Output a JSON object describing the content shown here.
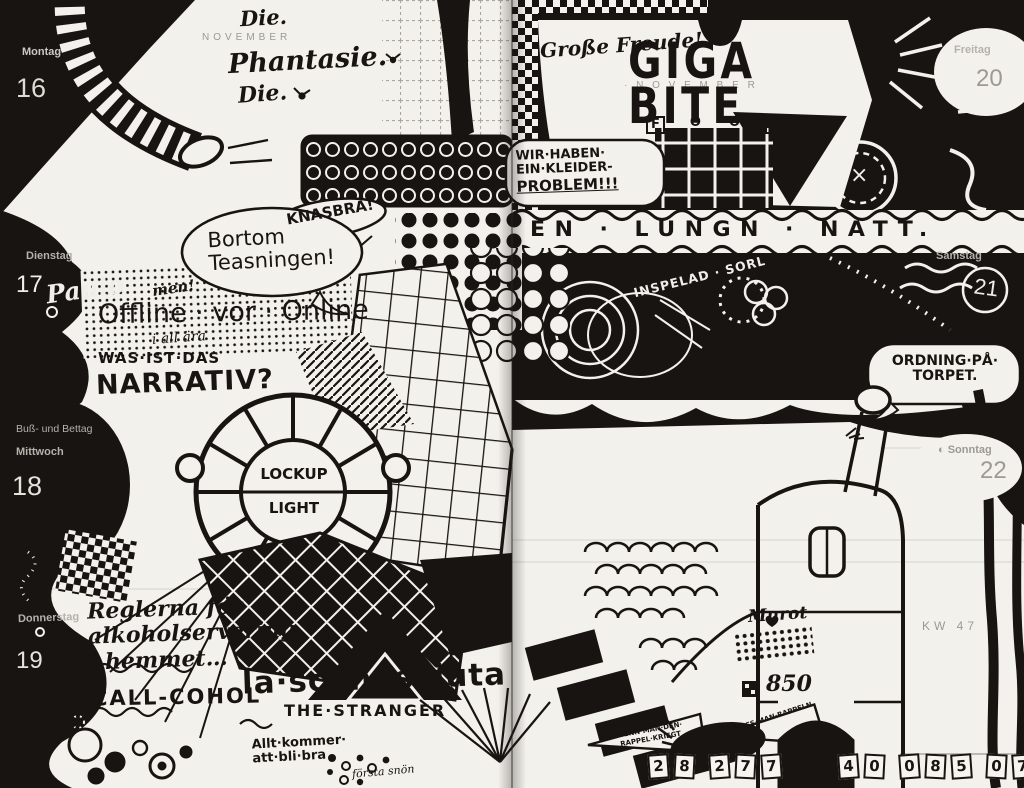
{
  "meta": {
    "description": "Hand-drawn black ink doodle art covering a two-page weekly planner spread",
    "week_label": "KW 47"
  },
  "calendar": {
    "left_month": "NOVEMBER",
    "right_month": "· N O V E M B E R",
    "week": "KW 47",
    "days": [
      {
        "name": "Montag",
        "date": "16"
      },
      {
        "name": "Dienstag",
        "date": "17",
        "note": "Paulo"
      },
      {
        "name": "Mittwoch",
        "date": "18",
        "holiday": "Buß- und Bettag"
      },
      {
        "name": "Donnerstag",
        "date": "19"
      },
      {
        "name": "Freitag",
        "date": "20"
      },
      {
        "name": "Samstag",
        "date": "21"
      },
      {
        "name": "Sonntag",
        "date": "22",
        "moon_icon": "◐"
      }
    ]
  },
  "icons": {
    "moon": "◐",
    "die": "▦"
  },
  "doodle_texts": {
    "die1": "Die.",
    "phantasie": "Phantasie.",
    "die2": "Die.",
    "grosse_freude": "Große Freude!",
    "giga": "GIGA",
    "bite": "BITE",
    "food": [
      "F",
      "O",
      "O",
      "D"
    ],
    "kleider1": "WIR·HABEN·",
    "kleider2": "EIN·KLEIDER-",
    "kleider3": "PROBLEM!!!",
    "lungn": "EN · LUNGN · NATT.",
    "knasbra": "KNASBRA!",
    "bortom1": "Bortom",
    "bortom2": "Teasningen!",
    "men": "men!",
    "offline": "Offline · vor · Online",
    "i_all_ara": "i all ära",
    "inspelad": "INSPELAD · SORL",
    "narrativ1": "WAS·IST·DAS",
    "narrativ2": "NARRATIV?",
    "x_mark": "×",
    "ordning1": "ORDNING·PÅ·",
    "ordning2": "TORPET.",
    "lockup": "LOCKUP",
    "light": "LIGHT",
    "reglerna1": "Reglerna för",
    "reglerna2": "alkoholservering",
    "reglerna3": "i hemmet…",
    "callcohol": "CALL-COHOL",
    "sconosciuta": "la·sconosciuta",
    "stranger": "THE·STRANGER",
    "allt1": "Allt·kommer·",
    "allt2": "att·bli·bra",
    "forsta_snon": "första snön",
    "rappel1": "WENN·MAN·DEN·",
    "rappel2": "RAPPEL·KRIEGT",
    "rappel3": "MUSS·MAN·RAPPELN",
    "murot": "Murot",
    "num_850": "850",
    "digits_left": [
      "2",
      "8",
      "2",
      "7",
      "7"
    ],
    "digits_mid": "AV",
    "digits_right": [
      "4",
      "0",
      "0",
      "8",
      "5",
      "0",
      "7",
      "1"
    ]
  }
}
